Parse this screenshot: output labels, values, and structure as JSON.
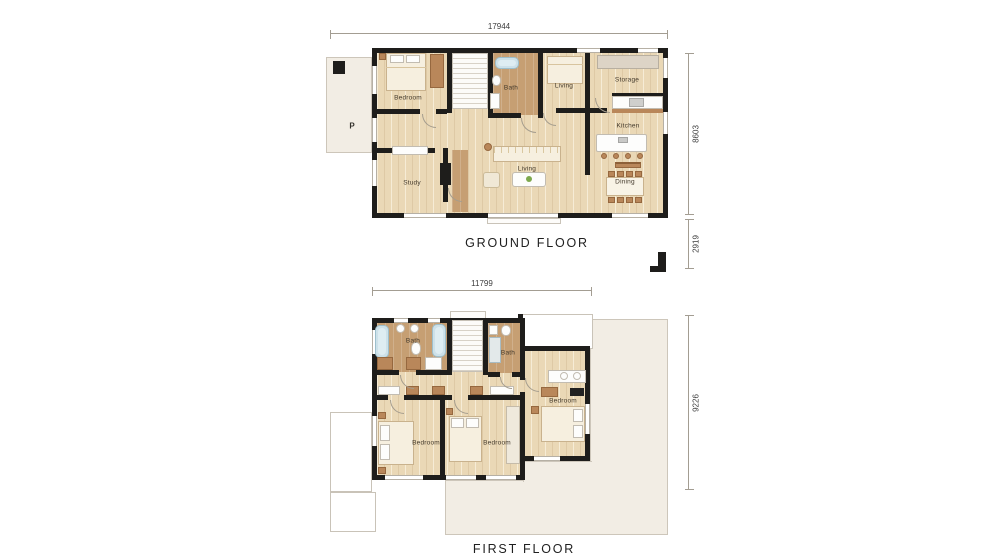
{
  "document": {
    "type": "architectural floor plan drawing",
    "background_color": "#ffffff"
  },
  "colors": {
    "wall": "#1e1d1b",
    "wood_floor": "#ead8b6",
    "bath_floor": "#c69f73",
    "terrace": "#f2ede4",
    "tub": "#cde1e9",
    "furniture_wood": "#b9875a",
    "dimension_line": "#a39d92"
  },
  "ground_floor": {
    "title": "GROUND FLOOR",
    "dims": {
      "width": "17944",
      "height": "8603",
      "setback": "2919"
    },
    "parking_label": "P",
    "rooms": [
      {
        "label": "Bedroom"
      },
      {
        "label": "Bath"
      },
      {
        "label": "Living"
      },
      {
        "label": "Storage"
      },
      {
        "label": "Kitchen"
      },
      {
        "label": "Dining"
      },
      {
        "label": "Living"
      },
      {
        "label": "Study"
      }
    ]
  },
  "first_floor": {
    "title": "FIRST FLOOR",
    "dims": {
      "width": "11799",
      "height": "9226"
    },
    "rooms": [
      {
        "label": "Bath"
      },
      {
        "label": "Bath"
      },
      {
        "label": "Bedroom"
      },
      {
        "label": "Bedroom"
      },
      {
        "label": "Bedroom"
      }
    ]
  }
}
